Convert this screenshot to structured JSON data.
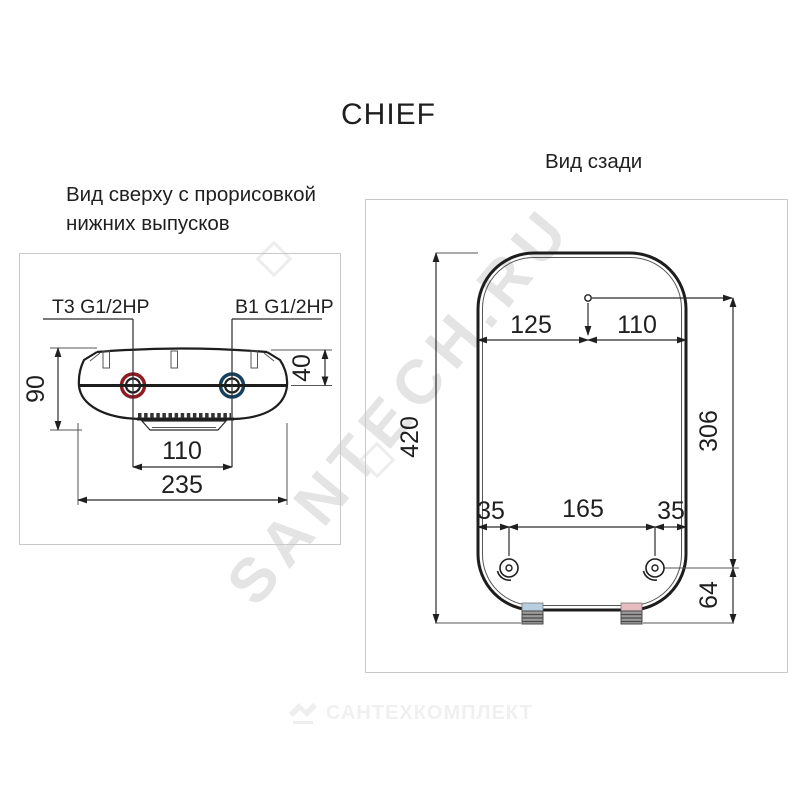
{
  "product_title": "CHIEF",
  "top_view": {
    "title_line1": "Вид сверху с прорисовкой",
    "title_line2": "нижних выпусков",
    "hot_outlet_label": "Т3 G1/2HP",
    "cold_outlet_label": "В1 G1/2HP",
    "dim_height": "90",
    "dim_outlet_depth": "40",
    "dim_outlet_spacing": "110",
    "dim_width": "235"
  },
  "rear_view": {
    "title": "Вид сзади",
    "dim_height": "420",
    "dim_top_left": "125",
    "dim_top_right": "110",
    "dim_bracket_drop": "306",
    "dim_bracket_left": "35",
    "dim_bracket_center": "165",
    "dim_bracket_right": "35",
    "dim_bottom": "64"
  },
  "watermark": {
    "diagonal_text": "SANTECH.RU",
    "footer_text": "САНТЕХКОМПЛЕКТ"
  },
  "colors": {
    "hot_ring": "#8e1c22",
    "cold_ring": "#17405f",
    "cold_band": "#b7cde0",
    "hot_band": "#e6bcbe",
    "line": "#1f1f1f",
    "panel_border": "#c9c9c9",
    "watermark_gray": "#e4e4e4",
    "footer_gray": "#f0f0f0"
  }
}
